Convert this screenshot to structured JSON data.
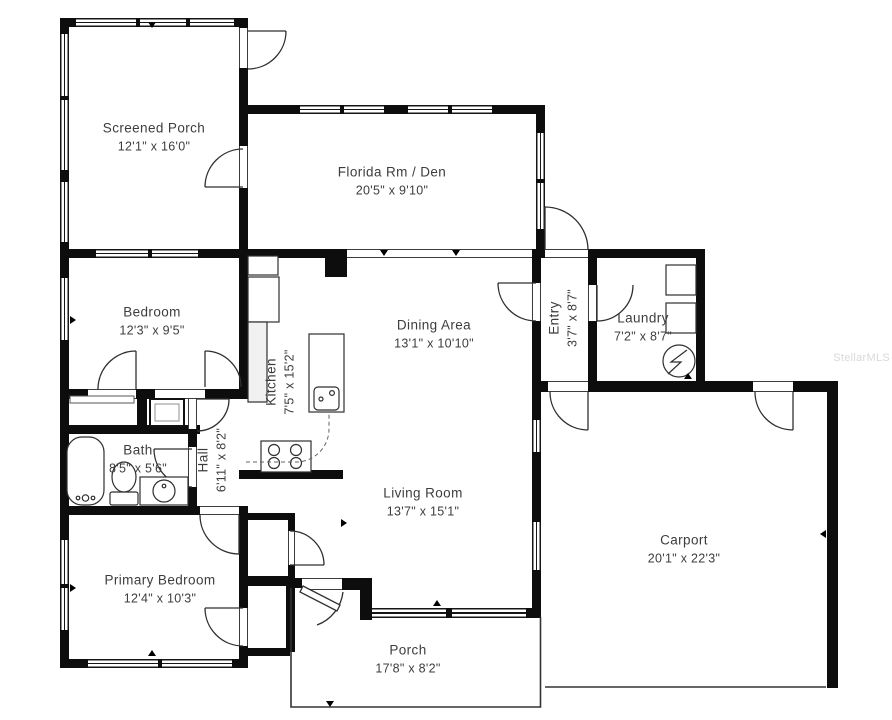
{
  "rooms": {
    "screened_porch": {
      "name": "Screened Porch",
      "dims": "12'1\" x 16'0\""
    },
    "florida_room": {
      "name": "Florida Rm / Den",
      "dims": "20'5\" x 9'10\""
    },
    "bedroom": {
      "name": "Bedroom",
      "dims": "12'3\" x 9'5\""
    },
    "kitchen": {
      "name": "Kitchen",
      "dims": "7'5\" x 15'2\""
    },
    "dining_area": {
      "name": "Dining Area",
      "dims": "13'1\" x 10'10\""
    },
    "entry": {
      "name": "Entry",
      "dims": "3'7\" x 8'7\""
    },
    "laundry": {
      "name": "Laundry",
      "dims": "7'2\" x 8'7\""
    },
    "bath": {
      "name": "Bath",
      "dims": "8'5\" x 5'6\""
    },
    "hall": {
      "name": "Hall",
      "dims": "6'11\" x 8'2\""
    },
    "living_room": {
      "name": "Living Room",
      "dims": "13'7\" x 15'1\""
    },
    "carport": {
      "name": "Carport",
      "dims": "20'1\" x 22'3\""
    },
    "primary_bedroom": {
      "name": "Primary Bedroom",
      "dims": "12'4\" x 10'3\""
    },
    "porch": {
      "name": "Porch",
      "dims": "17'8\" x 8'2\""
    }
  },
  "watermark": "StellarMLS",
  "colors": {
    "wall": "#0d0d0d",
    "line": "#2f2f2f",
    "text": "#3d3d3d",
    "watermark": "#d9d9d9"
  }
}
